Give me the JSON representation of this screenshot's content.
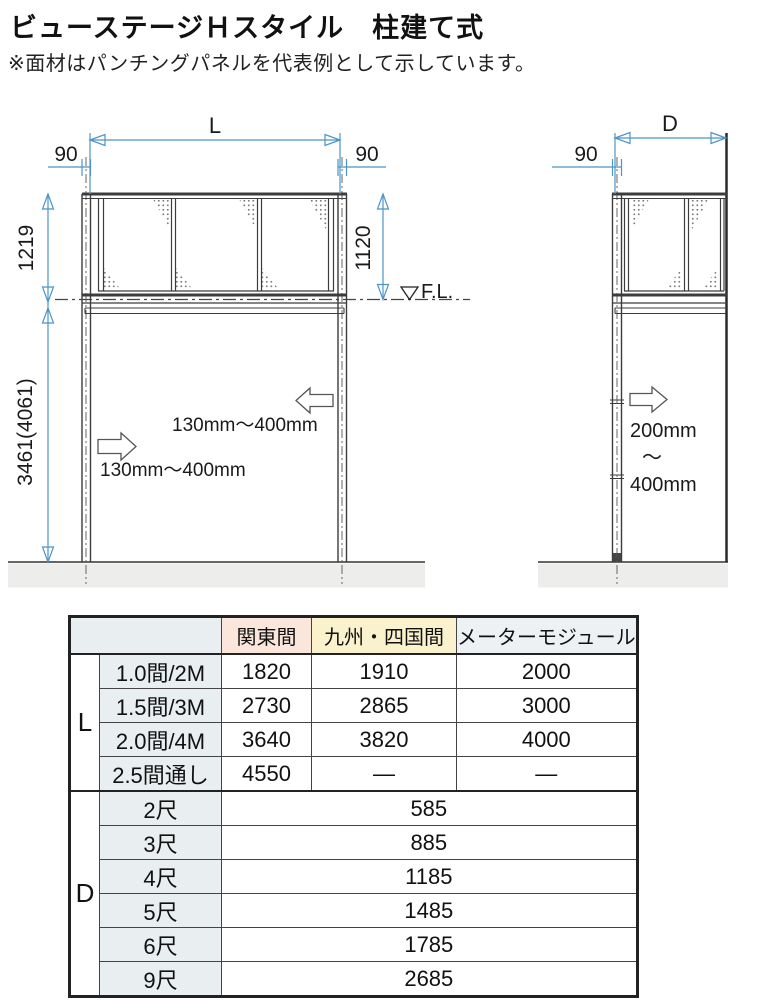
{
  "page": {
    "title": "ビューステージＨスタイル　柱建て式",
    "note": "※面材はパンチングパネルを代表例として示しています。"
  },
  "colors": {
    "dimension_blue": "#4e94c8",
    "drawing_line": "#3c3c3c",
    "kanto_header_bg": "#fbe6dc",
    "kyushu_header_bg": "#f9f2cd",
    "meter_header_bg": "#edf1f3",
    "sublabel_bg": "#e9eef1",
    "ground_gray": "#ededeb"
  },
  "front_view": {
    "dim_l": "L",
    "dim_90_left": "90",
    "dim_90_right": "90",
    "dim_rail_left": "1219",
    "dim_rail_right": "1120",
    "fl_label": "F.L.",
    "dim_total": "3461(4061)",
    "arrow_label_upper": "130mm〜400mm",
    "arrow_label_lower": "130mm〜400mm"
  },
  "side_view": {
    "dim_d": "D",
    "dim_90": "90",
    "range_top": "200mm",
    "range_tilde": "〜",
    "range_bottom": "400mm"
  },
  "table": {
    "corner": "",
    "headers": [
      "関東間",
      "九州・四国間",
      "メーターモジュール"
    ],
    "l_group": {
      "label": "L",
      "rows": [
        {
          "name": "1.0間/2M",
          "values": [
            "1820",
            "1910",
            "2000"
          ]
        },
        {
          "name": "1.5間/3M",
          "values": [
            "2730",
            "2865",
            "3000"
          ]
        },
        {
          "name": "2.0間/4M",
          "values": [
            "3640",
            "3820",
            "4000"
          ]
        },
        {
          "name": "2.5間通し",
          "values": [
            "4550",
            "—",
            "—"
          ]
        }
      ]
    },
    "d_group": {
      "label": "D",
      "rows": [
        {
          "name": "2尺",
          "value": "585"
        },
        {
          "name": "3尺",
          "value": "885"
        },
        {
          "name": "4尺",
          "value": "1185"
        },
        {
          "name": "5尺",
          "value": "1485"
        },
        {
          "name": "6尺",
          "value": "1785"
        },
        {
          "name": "9尺",
          "value": "2685"
        }
      ]
    }
  }
}
